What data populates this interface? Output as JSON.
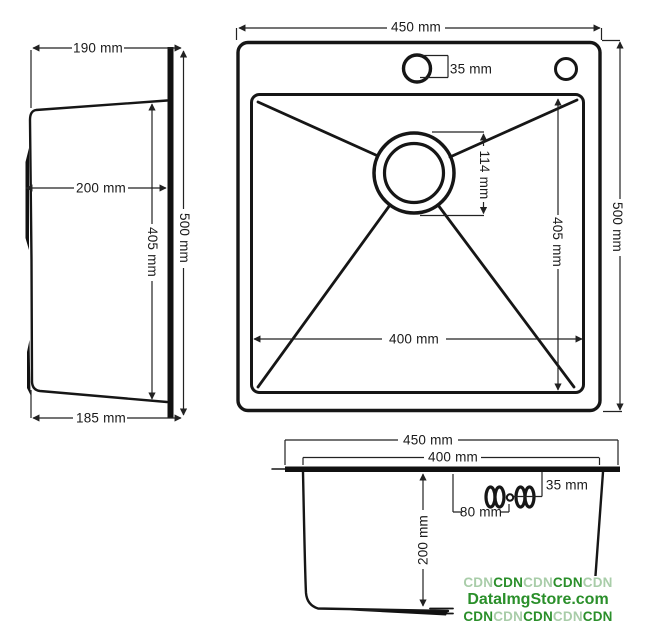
{
  "side_view": {
    "top_width": "190 mm",
    "bowl_depth": "200 mm",
    "inner_height": "405 mm",
    "overall_height": "500 mm",
    "bottom_width": "185 mm"
  },
  "plan_view": {
    "overall_width": "450 mm",
    "faucet_hole": "35 mm",
    "drain_diameter": "114 mm",
    "inner_length": "405 mm",
    "overall_length": "500 mm",
    "inner_width": "400 mm"
  },
  "section_view": {
    "overall_width": "450 mm",
    "inner_width": "400 mm",
    "faucet_hole": "35 mm",
    "faucet_offset": "80 mm",
    "bowl_depth": "200 mm"
  },
  "watermark": {
    "line1": [
      "CDN",
      "CDN",
      "CDN",
      "CDN",
      "CDN"
    ],
    "line2": "DataImgStore.com",
    "line3": [
      "CDN",
      "CDN",
      "CDN",
      "CDN",
      "CDN"
    ],
    "colors": {
      "dark_green": "#2a8f2a",
      "light_green": "#a9cda9"
    }
  }
}
